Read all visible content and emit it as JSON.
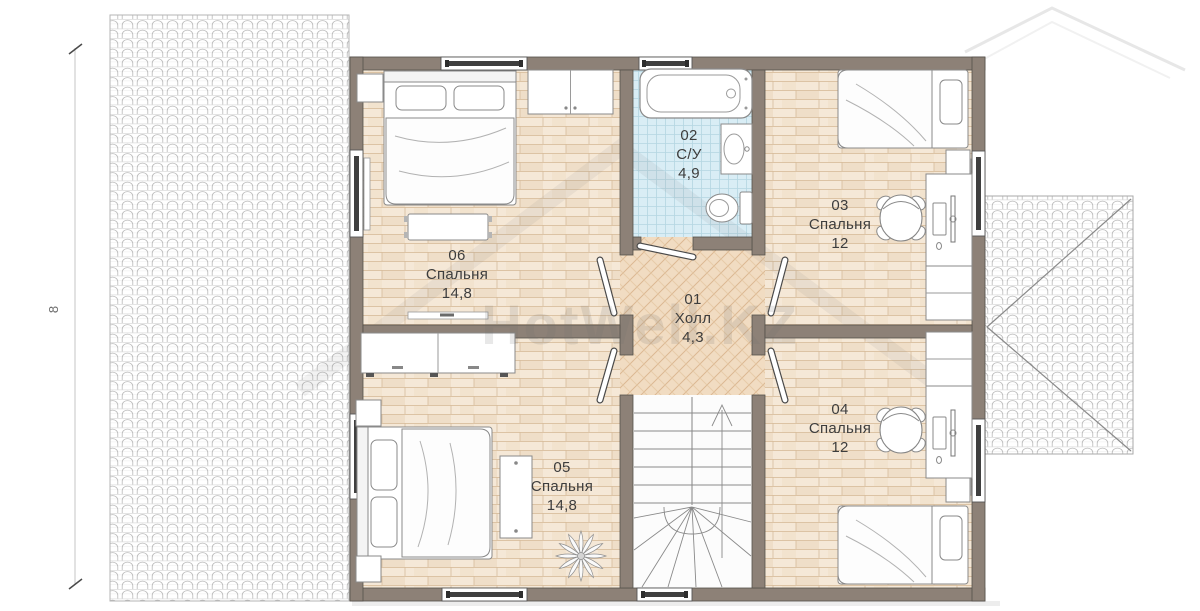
{
  "watermark": {
    "text": "HotWell.KZ"
  },
  "dimensions": {
    "left_height": "8"
  },
  "rooms": [
    {
      "number": "01",
      "name": "Холл",
      "area": "4,3"
    },
    {
      "number": "02",
      "name": "С/У",
      "area": "4,9"
    },
    {
      "number": "03",
      "name": "Спальня",
      "area": "12"
    },
    {
      "number": "04",
      "name": "Спальня",
      "area": "12"
    },
    {
      "number": "05",
      "name": "Спальня",
      "area": "14,8"
    },
    {
      "number": "06",
      "name": "Спальня",
      "area": "14,8"
    }
  ],
  "colors": {
    "wall": "#8d8177",
    "wood_floor": "#f5e8d7",
    "bath_floor": "#d9edf5",
    "hall_floor": "#f1dcc2",
    "stair_floor": "#fcfcfc",
    "roof_line": "#b9b9b9"
  }
}
